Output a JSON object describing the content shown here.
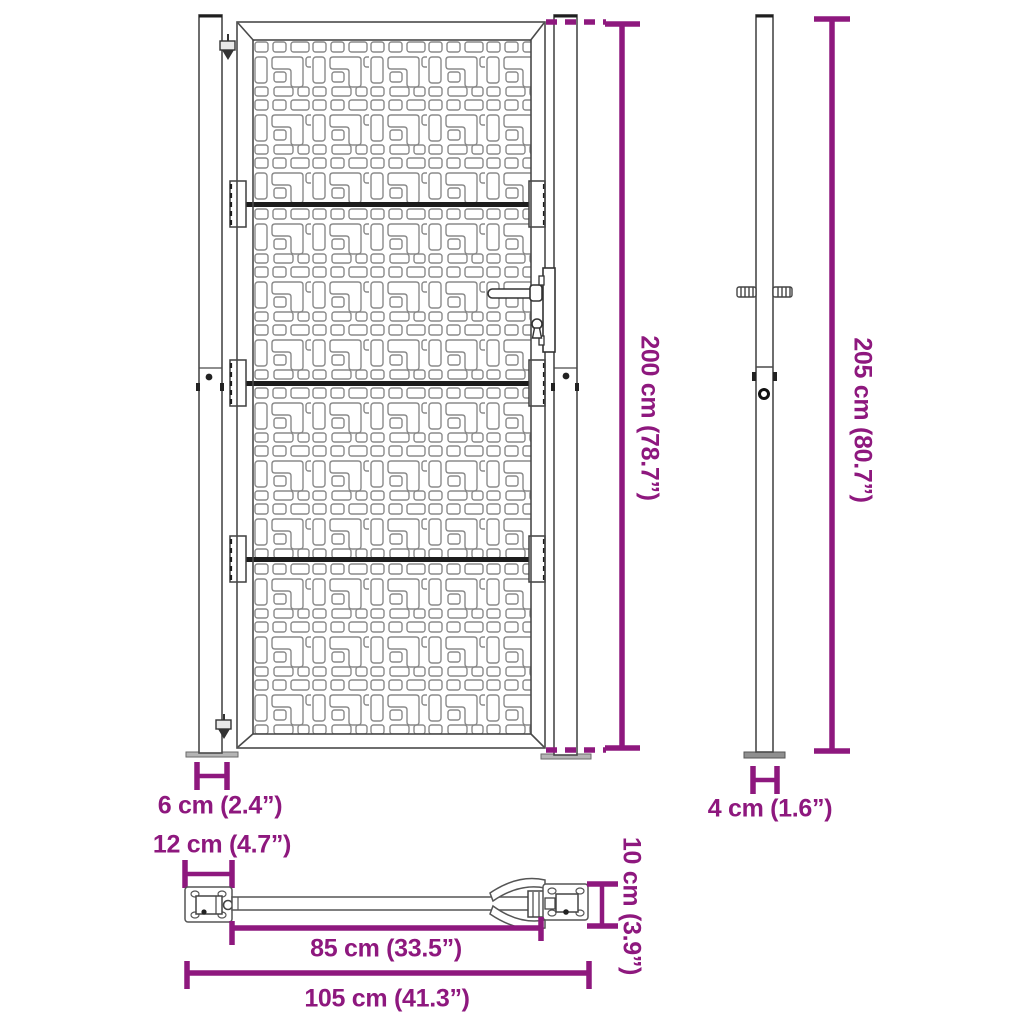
{
  "colors": {
    "dimension": "#8E187E",
    "outline": "#3f3f3f",
    "pattern_line": "#8a8a8a"
  },
  "dimensions": {
    "gate_height": "200 cm (78.7”)",
    "post_height": "205 cm (80.7”)",
    "gate_post_width": "6 cm (2.4”)",
    "side_post_width": "4 cm (1.6”)",
    "plate_width": "12 cm (4.7”)",
    "plate_depth": "10 cm (3.9”)",
    "inner_width": "85 cm (33.5”)",
    "total_width": "105 cm (41.3”)"
  }
}
